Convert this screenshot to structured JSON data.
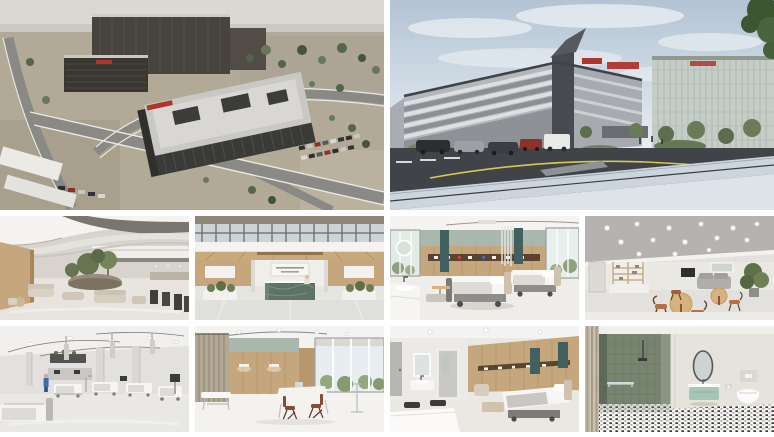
{
  "page": {
    "background": "#ffffff",
    "description": "Collage of ten architectural renderings of a new hospital campus: two large exterior views on top, four interior views in the middle row and four interior views in the bottom row."
  },
  "colors": {
    "accent-red": "#b0352c",
    "ground-tan": "#b2aa97",
    "facade-dark": "#43423e",
    "facade-anthracite": "#474b51",
    "facade-light": "#b4b7ba",
    "sky-blue": "#bccbdb",
    "asphalt": "#404347",
    "road-yellow": "#d8c84e",
    "tree-green": "#5c6c49",
    "wood": "#c6a77d",
    "sage": "#a9b7ad",
    "teal": "#41605f",
    "mint": "#a7c6ba",
    "shower-green": "#77846f",
    "marble-green": "#5e7266",
    "cognac": "#b5713f",
    "scrubs-blue": "#3f6fa8"
  },
  "collage": {
    "grid": {
      "top_row_tiles": 2,
      "middle_row_tiles": 4,
      "bottom_row_tiles": 4
    },
    "tiles": [
      {
        "id": "aerial-campus",
        "row": "top",
        "label": "Aerial rendering of hospital campus with dark facade buildings, red rooftop signage, parking lots, access roads, parked cars and landscaping"
      },
      {
        "id": "street-view",
        "row": "top",
        "label": "Street-level rendering of hospital building with anthracite corner, red rooftop signage, glass tower, trees, parked cars and curved road markings under a blue sky"
      },
      {
        "id": "atrium-lobby",
        "row": "middle",
        "label": "Interior rendering of multi-storey atrium lobby with curved white ceiling bands, indoor trees, stone planter and beige lounge seating"
      },
      {
        "id": "entrance-hall",
        "row": "middle",
        "label": "Interior rendering of symmetric entrance hall with glazed skylight, wood-clad walls, white sign board and green marble reception desk"
      },
      {
        "id": "double-patient-room",
        "row": "middle",
        "label": "Interior rendering of double patient room with two hospital beds, wood headwall with service rail, sage green band, teal panels, windows and washbasin with round mirror"
      },
      {
        "id": "family-lounge",
        "row": "middle",
        "label": "Interior rendering of lounge with grey ceiling and round recessed lights, open shelving, grey sofa, round wooden tables, cognac chairs and a plant"
      },
      {
        "id": "icu-ward",
        "row": "bottom",
        "label": "Interior rendering of open intensive-care ward in white and grey with ceiling booms, columns, several patient beds, monitors and a staff member in blue scrubs"
      },
      {
        "id": "exam-room",
        "row": "bottom",
        "label": "Interior rendering of examination room with beige privacy curtain, wood panelling with sage band, windows with greenery, white desk and two red-brown chairs"
      },
      {
        "id": "single-patient-room",
        "row": "bottom",
        "label": "Interior rendering of single patient room with bed, wood headwall with teal panels, bench, washbasin with lit mirror niche and foreground table"
      },
      {
        "id": "patient-bathroom",
        "row": "bottom",
        "label": "Interior rendering of accessible bathroom with green tiled walk-in shower, grab bar, oval mirror, mint vanity, wall-hung toilet and black-and-white mosaic floor"
      }
    ]
  }
}
